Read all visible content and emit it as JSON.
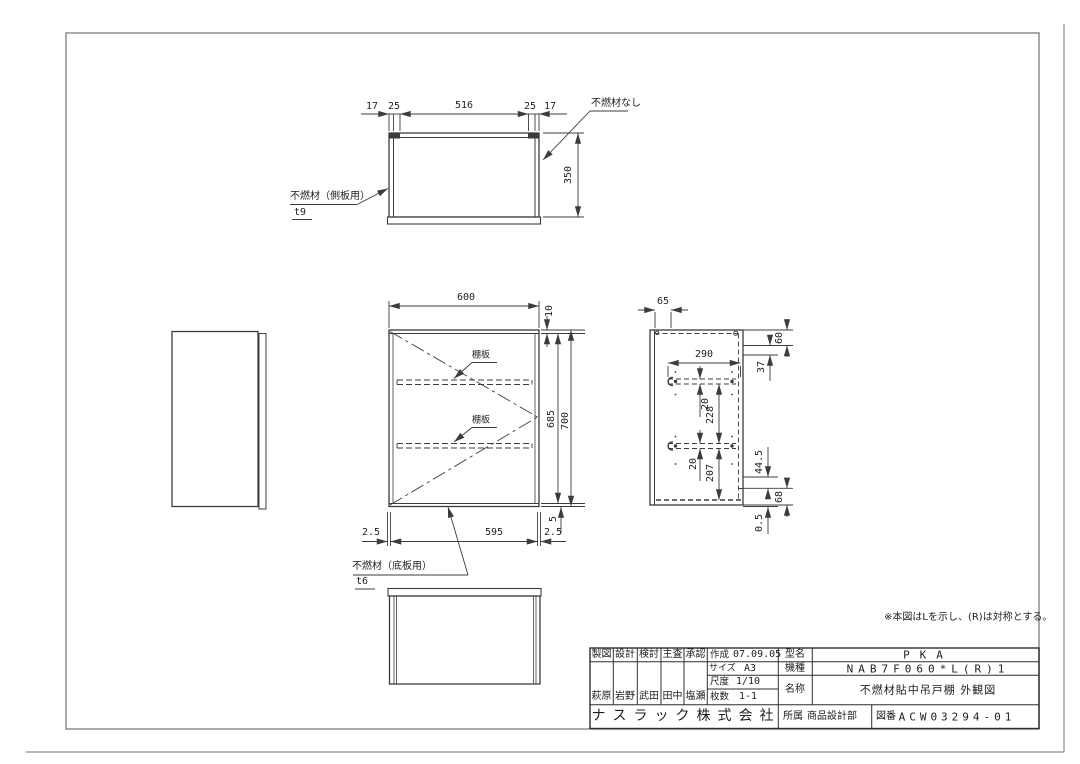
{
  "sheet": {
    "note": "※本図はLを示し、(R)は対称とする。"
  },
  "top_view": {
    "dim_17_left": "17",
    "dim_25_left": "25",
    "dim_516": "516",
    "dim_25_right": "25",
    "dim_17_right": "17",
    "dim_350": "350",
    "label_no_incombustible": "不燃材なし",
    "label_side_incombustible": "不燃材（側板用）",
    "label_side_thickness": "t9"
  },
  "front_view": {
    "dim_600": "600",
    "dim_10": "10",
    "dim_685": "685",
    "dim_700": "700",
    "dim_5": "5",
    "dim_2_5_left": "2.5",
    "dim_595": "595",
    "dim_2_5_right": "2.5",
    "label_shelf_1": "棚板",
    "label_shelf_2": "棚板",
    "label_bottom_incombustible": "不燃材（底板用）",
    "label_bottom_thickness": "t6"
  },
  "side_view": {
    "dim_65": "65",
    "dim_290": "290",
    "dim_20_upper": "20",
    "dim_228": "228",
    "dim_20_lower": "20",
    "dim_207": "207",
    "dim_60": "60",
    "dim_37": "37",
    "dim_44_5": "44.5",
    "dim_68": "68",
    "dim_0_5": "0.5"
  },
  "title_block": {
    "sign_headers": [
      "製図",
      "設計",
      "検討",
      "主査",
      "承認"
    ],
    "sign_names": [
      "萩原",
      "岩野",
      "武田",
      "田中",
      "塩瀬"
    ],
    "created_label": "作成",
    "created_value": "07.09.05",
    "size_label": "サイズ",
    "size_value": "A3",
    "scale_label": "尺度",
    "scale_value": "1/10",
    "sheets_label": "枚数",
    "sheets_value": "1-1",
    "model_label": "型名",
    "model_value": "PKA",
    "machine_label": "機種",
    "machine_value": "NAB7F060*L(R)1",
    "name_label": "名称",
    "name_value": "不燃材貼中吊戸棚 外観図",
    "company": "ナスラック株式会社",
    "dept_label": "所属",
    "dept_value": "商品設計部",
    "dwg_no_label": "図番",
    "dwg_no_value": "ACW03294-01"
  }
}
